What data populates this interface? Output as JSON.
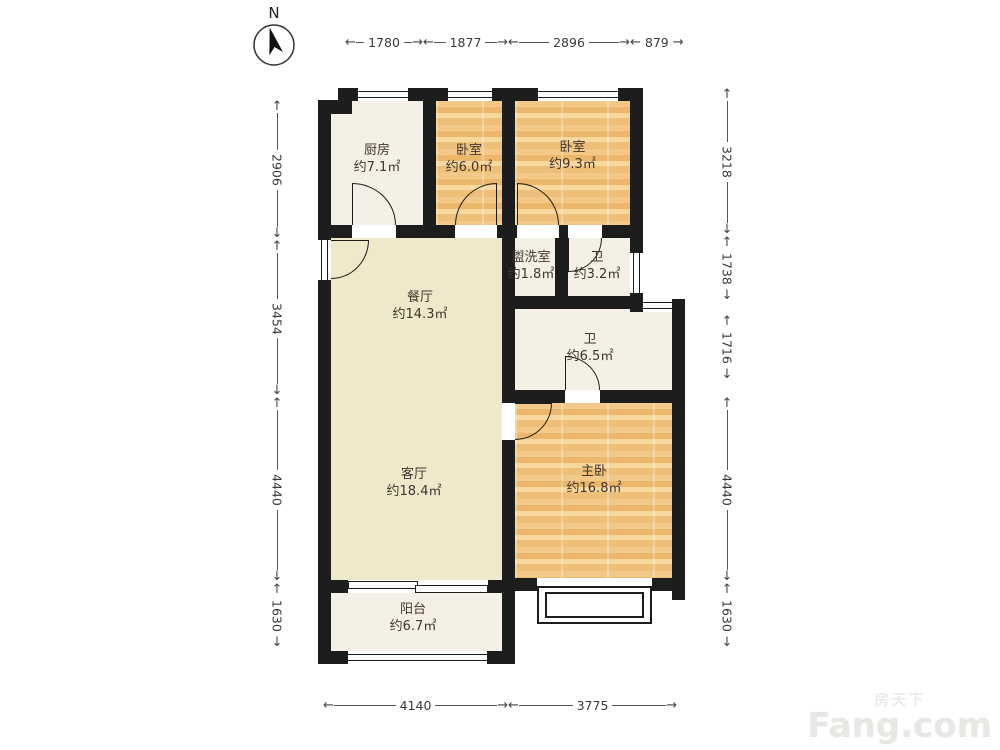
{
  "compass": {
    "label": "N"
  },
  "rooms": [
    {
      "id": "kitchen",
      "name": "厨房",
      "area": "约7.1㎡"
    },
    {
      "id": "bedroom-small",
      "name": "卧室",
      "area": "约6.0㎡"
    },
    {
      "id": "bedroom-mid",
      "name": "卧室",
      "area": "约9.3㎡"
    },
    {
      "id": "washroom",
      "name": "盥洗室",
      "area": "约1.8㎡"
    },
    {
      "id": "bath-small",
      "name": "卫",
      "area": "约3.2㎡"
    },
    {
      "id": "dining",
      "name": "餐厅",
      "area": "约14.3㎡"
    },
    {
      "id": "bath-large",
      "name": "卫",
      "area": "约6.5㎡"
    },
    {
      "id": "living",
      "name": "客厅",
      "area": "约18.4㎡"
    },
    {
      "id": "master",
      "name": "主卧",
      "area": "约16.8㎡"
    },
    {
      "id": "balcony",
      "name": "阳台",
      "area": "约6.7㎡"
    }
  ],
  "dimensions": {
    "top": [
      {
        "value": "1780"
      },
      {
        "value": "1877"
      },
      {
        "value": "2896"
      },
      {
        "value": "879"
      }
    ],
    "bottom": [
      {
        "value": "4140"
      },
      {
        "value": "3775"
      }
    ],
    "left": [
      {
        "value": "2906"
      },
      {
        "value": "3454"
      },
      {
        "value": "4440"
      },
      {
        "value": "1630"
      }
    ],
    "right": [
      {
        "value": "3218"
      },
      {
        "value": "1738"
      },
      {
        "value": "1716"
      },
      {
        "value": "4440"
      },
      {
        "value": "1630"
      }
    ]
  },
  "watermark": {
    "cn": "房天下",
    "en": "Fang.com"
  },
  "colors": {
    "wall": "#1d1d1d",
    "wood_floor": "#eec077",
    "tile_floor": "#f4f0e5",
    "hall_floor": "#efe8cb",
    "dimension_text": "#3a3a3a"
  }
}
